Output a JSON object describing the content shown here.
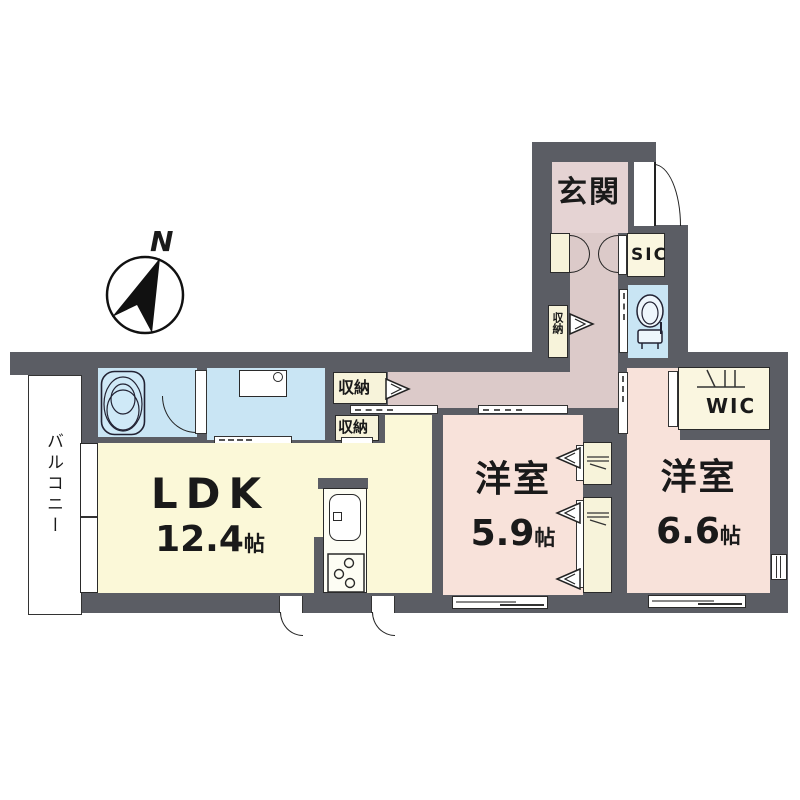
{
  "title": "マンション間取り図",
  "compass": {
    "label": "N"
  },
  "balcony": {
    "label": "バルコニー"
  },
  "rooms": {
    "genkan": {
      "label": "玄関"
    },
    "sic": {
      "label": "SIC"
    },
    "wic": {
      "label": "WIC"
    },
    "ldk": {
      "name": "LDK",
      "size_value": "12.4",
      "size_unit": "帖"
    },
    "west1": {
      "name": "洋室",
      "size_value": "5.9",
      "size_unit": "帖"
    },
    "west2": {
      "name": "洋室",
      "size_value": "6.6",
      "size_unit": "帖"
    }
  },
  "storage": {
    "hall": "収納",
    "corridor": "収納",
    "kitchen": "収納"
  },
  "colors": {
    "wall": "#5b5d64",
    "water_room": "#c9e5f4",
    "western_room": "#f8e2da",
    "hallway": "#dccac9",
    "entrance": "#e5d3d3",
    "ldk": "#fbf8d8",
    "closet": "#f7f3da",
    "line": "#222222"
  }
}
